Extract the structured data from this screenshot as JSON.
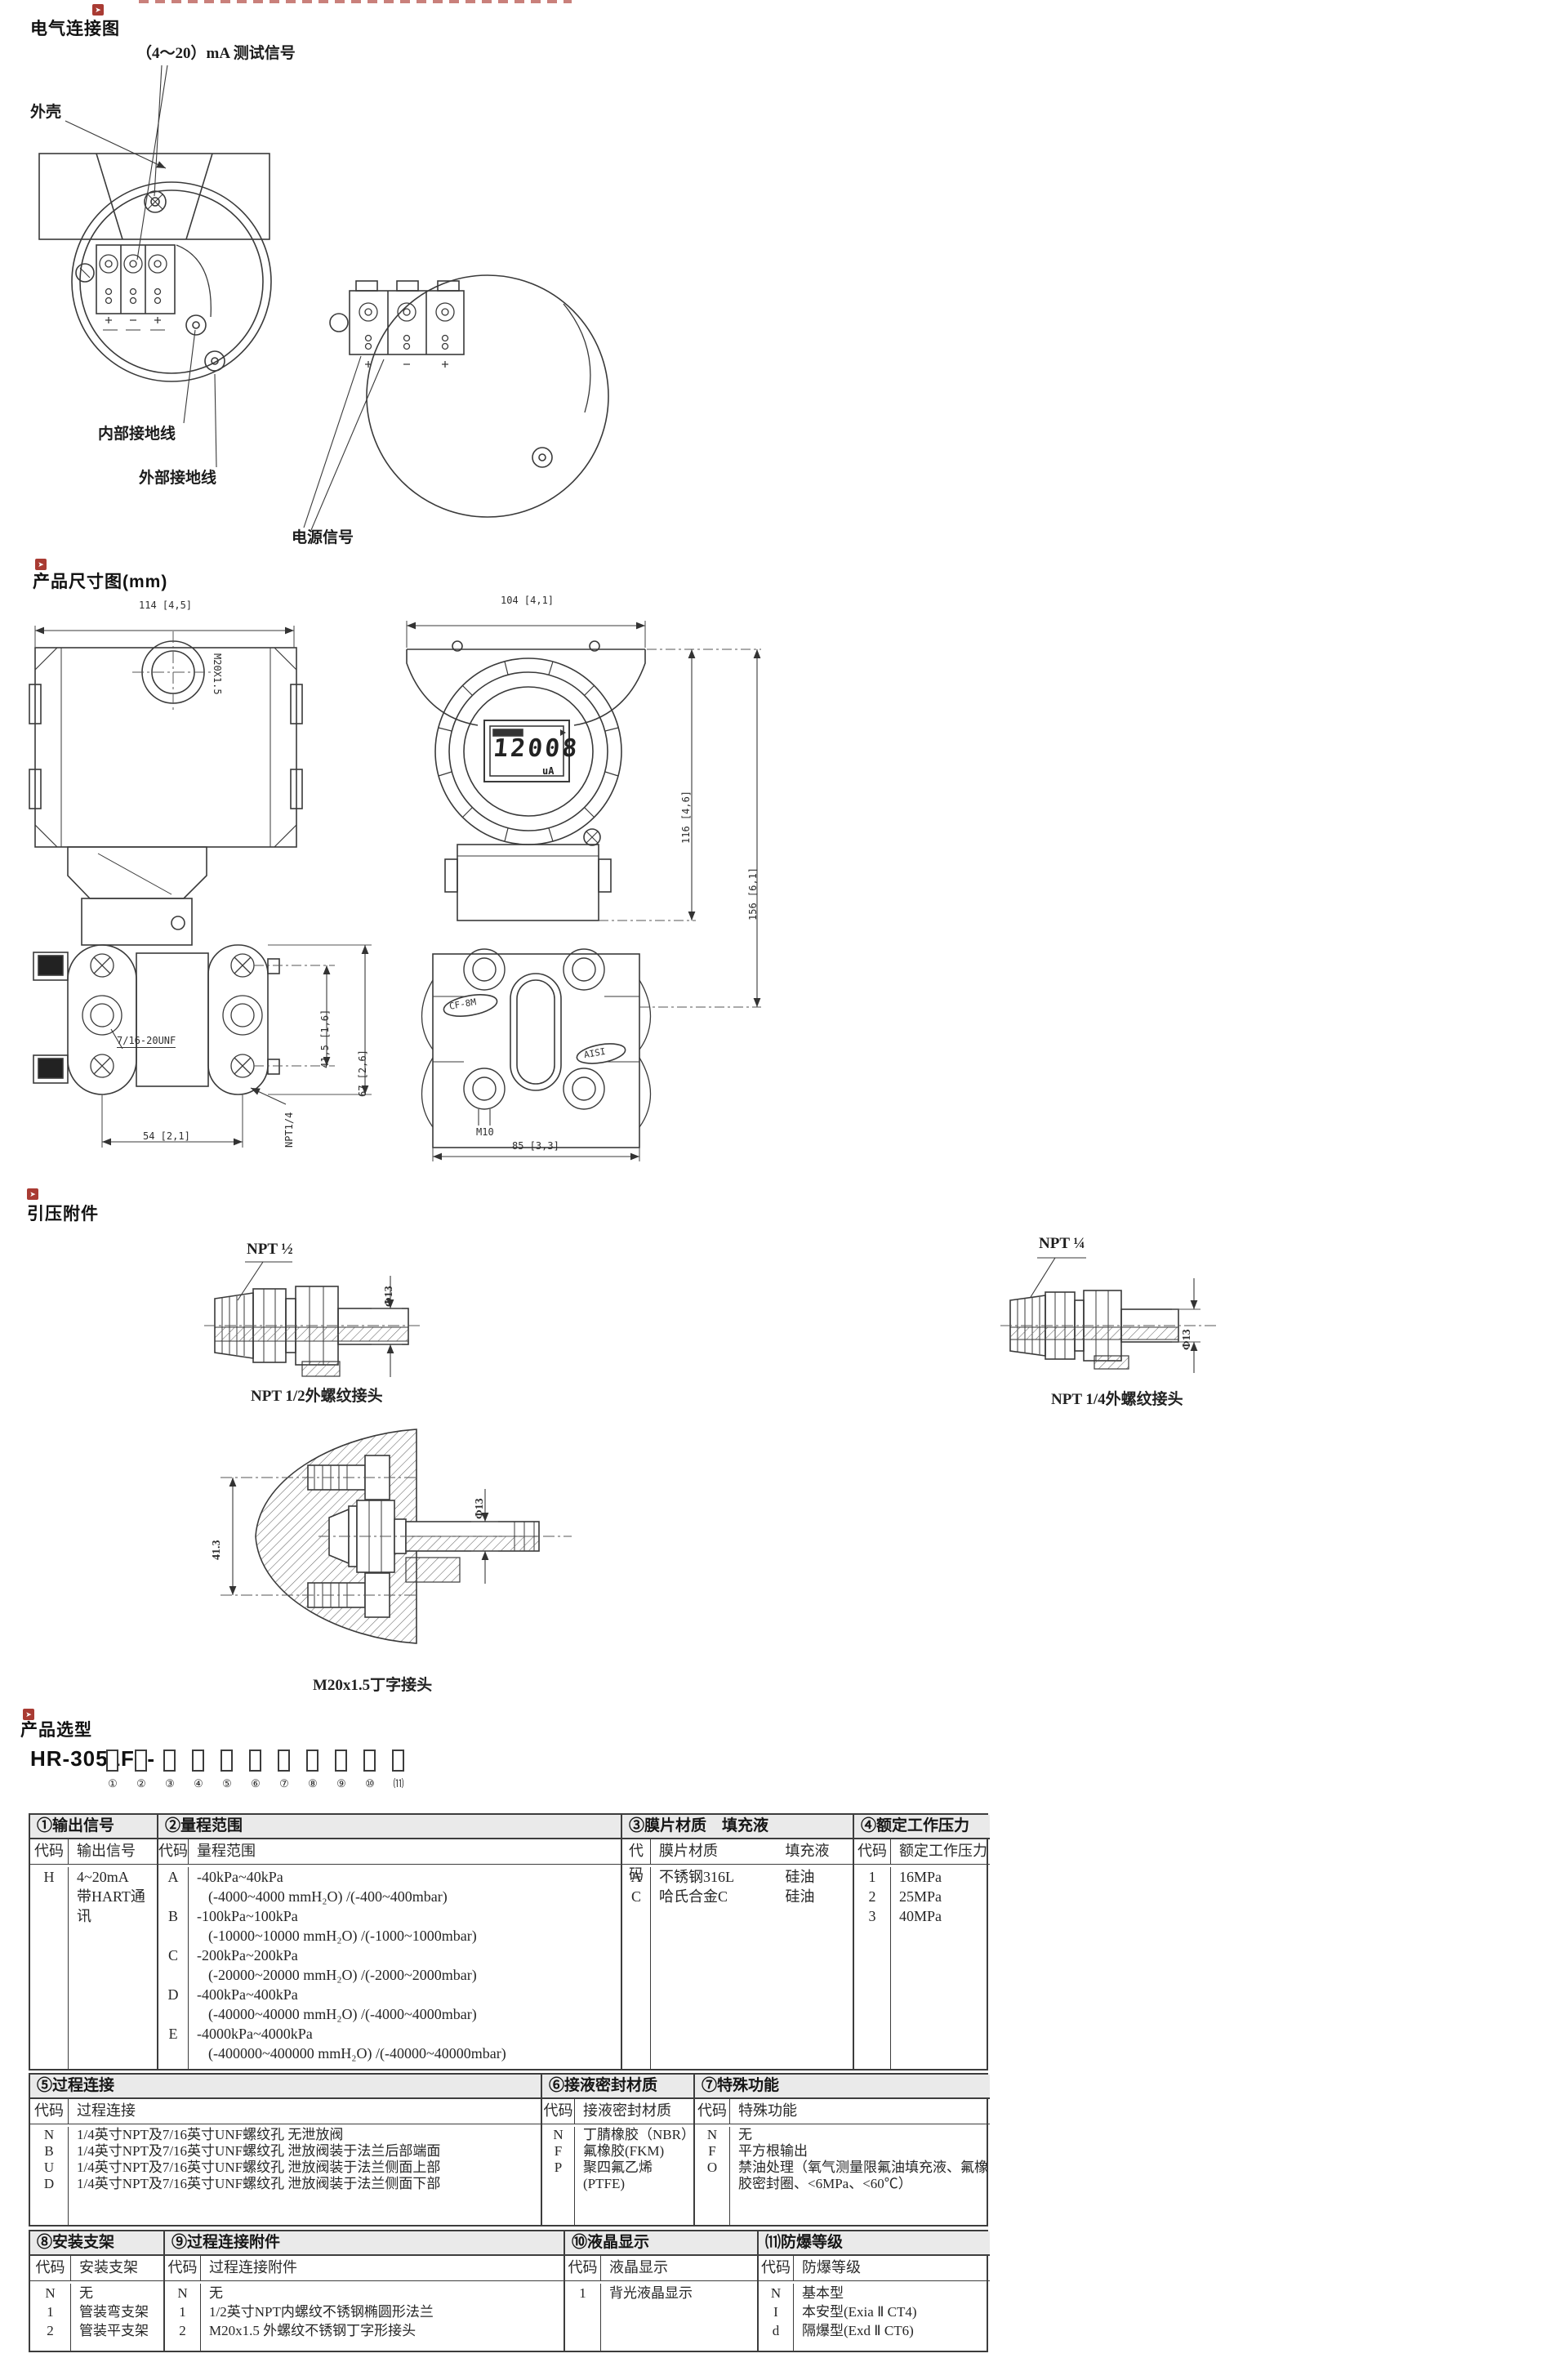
{
  "icons": {
    "section_marker": "➤"
  },
  "elec": {
    "title": "电气连接图",
    "labels": {
      "test_signal": "（4～20）mA 测试信号",
      "housing": "外壳",
      "internal_ground": "内部接地线",
      "external_ground": "外部接地线",
      "power_signal": "电源信号"
    }
  },
  "dims": {
    "title": "产品尺寸图(mm)",
    "front": {
      "width": "114 [4,5]",
      "conduit": "M20X1.5",
      "bolt_thread": "7/16-20UNF",
      "pitch": "41,5 [1,6]",
      "height": "67 [2,6]",
      "span": "54 [2,1]",
      "port": "NPT1/4"
    },
    "side": {
      "width": "104 [4,1]",
      "lcd_value": "12008",
      "lcd_unit": "uA",
      "body_height": "116 [4,6]",
      "total_height": "156 [6,1]",
      "cast_mark": "CF-8M",
      "cast_mark2": "AISI",
      "anchor": "M10",
      "flange_width": "85 [3,3]"
    }
  },
  "fit": {
    "title": "引压附件",
    "npt_half": {
      "thread": "NPT ½",
      "dia": "Φ13",
      "caption": "NPT 1/2外螺纹接头"
    },
    "npt_quarter": {
      "thread": "NPT ¼",
      "dia": "Φ13",
      "caption": "NPT 1/4外螺纹接头"
    },
    "tee": {
      "length": "41.3",
      "dia": "Φ13",
      "caption": "M20x1.5丁字接头"
    }
  },
  "sel": {
    "title": "产品选型",
    "model_prefix": "HR-3051F1-",
    "positions": [
      "①",
      "②",
      "③",
      "④",
      "⑤",
      "⑥",
      "⑦",
      "⑧",
      "⑨",
      "⑩",
      "⑾"
    ],
    "t1": {
      "title": "①输出信号",
      "code_h": "代码",
      "desc_h": "输出信号",
      "rows": [
        {
          "code": "H",
          "lines": [
            "4~20mA",
            "带HART通讯"
          ]
        }
      ]
    },
    "t2": {
      "title": "②量程范围",
      "code_h": "代码",
      "desc_h": "量程范围",
      "rows": [
        {
          "code": "A",
          "lines": [
            "-40kPa~40kPa",
            "(-4000~4000 mmH₂O) /(-400~400mbar)"
          ]
        },
        {
          "code": "B",
          "lines": [
            "-100kPa~100kPa",
            "(-10000~10000 mmH₂O) /(-1000~1000mbar)"
          ]
        },
        {
          "code": "C",
          "lines": [
            "-200kPa~200kPa",
            "(-20000~20000 mmH₂O) /(-2000~2000mbar)"
          ]
        },
        {
          "code": "D",
          "lines": [
            "-400kPa~400kPa",
            "(-40000~40000 mmH₂O) /(-4000~4000mbar)"
          ]
        },
        {
          "code": "E",
          "lines": [
            "-4000kPa~4000kPa",
            "(-400000~400000 mmH₂O) /(-40000~40000mbar)"
          ]
        }
      ]
    },
    "t3": {
      "title": "③膜片材质　填充液",
      "code_h": "代码",
      "mat_h": "膜片材质",
      "fill_h": "填充液",
      "rows": [
        {
          "code": "A",
          "mat": "不锈钢316L",
          "fill": "硅油"
        },
        {
          "code": "C",
          "mat": "哈氏合金C",
          "fill": "硅油"
        }
      ]
    },
    "t4": {
      "title": "④额定工作压力",
      "code_h": "代码",
      "desc_h": "额定工作压力",
      "rows": [
        {
          "code": "1",
          "desc": "16MPa"
        },
        {
          "code": "2",
          "desc": "25MPa"
        },
        {
          "code": "3",
          "desc": "40MPa"
        }
      ]
    },
    "t5": {
      "title": "⑤过程连接",
      "code_h": "代码",
      "desc_h": "过程连接",
      "rows": [
        {
          "code": "N",
          "desc": "1/4英寸NPT及7/16英寸UNF螺纹孔 无泄放阀"
        },
        {
          "code": "B",
          "desc": "1/4英寸NPT及7/16英寸UNF螺纹孔 泄放阀装于法兰后部端面"
        },
        {
          "code": "U",
          "desc": "1/4英寸NPT及7/16英寸UNF螺纹孔 泄放阀装于法兰侧面上部"
        },
        {
          "code": "D",
          "desc": "1/4英寸NPT及7/16英寸UNF螺纹孔 泄放阀装于法兰侧面下部"
        }
      ]
    },
    "t6": {
      "title": "⑥接液密封材质",
      "code_h": "代码",
      "desc_h": "接液密封材质",
      "rows": [
        {
          "code": "N",
          "desc": "丁腈橡胶（NBR）"
        },
        {
          "code": "F",
          "desc": "氟橡胶(FKM)"
        },
        {
          "code": "P",
          "desc": "聚四氟乙烯(PTFE)"
        }
      ]
    },
    "t7": {
      "title": "⑦特殊功能",
      "code_h": "代码",
      "desc_h": "特殊功能",
      "rows": [
        {
          "code": "N",
          "desc": "无"
        },
        {
          "code": "F",
          "desc": "平方根输出"
        },
        {
          "code": "O",
          "desc": "禁油处理（氧气测量限氟油填充液、氟橡胶密封圈、<6MPa、<60℃）"
        }
      ]
    },
    "t8": {
      "title": "⑧安装支架",
      "code_h": "代码",
      "desc_h": "安装支架",
      "rows": [
        {
          "code": "N",
          "desc": "无"
        },
        {
          "code": "1",
          "desc": "管装弯支架"
        },
        {
          "code": "2",
          "desc": "管装平支架"
        }
      ]
    },
    "t9": {
      "title": "⑨过程连接附件",
      "code_h": "代码",
      "desc_h": "过程连接附件",
      "rows": [
        {
          "code": "N",
          "desc": "无"
        },
        {
          "code": "1",
          "desc": "1/2英寸NPT内螺纹不锈钢椭圆形法兰"
        },
        {
          "code": "2",
          "desc": "M20x1.5 外螺纹不锈钢丁字形接头"
        }
      ]
    },
    "t10": {
      "title": "⑩液晶显示",
      "code_h": "代码",
      "desc_h": "液晶显示",
      "rows": [
        {
          "code": "1",
          "desc": "背光液晶显示"
        }
      ]
    },
    "t11": {
      "title": "⑾防爆等级",
      "code_h": "代码",
      "desc_h": "防爆等级",
      "rows": [
        {
          "code": "N",
          "desc": "基本型"
        },
        {
          "code": "I",
          "desc": "本安型(Exia Ⅱ CT4)"
        },
        {
          "code": "d",
          "desc": "隔爆型(Exd Ⅱ CT6)"
        }
      ]
    }
  }
}
